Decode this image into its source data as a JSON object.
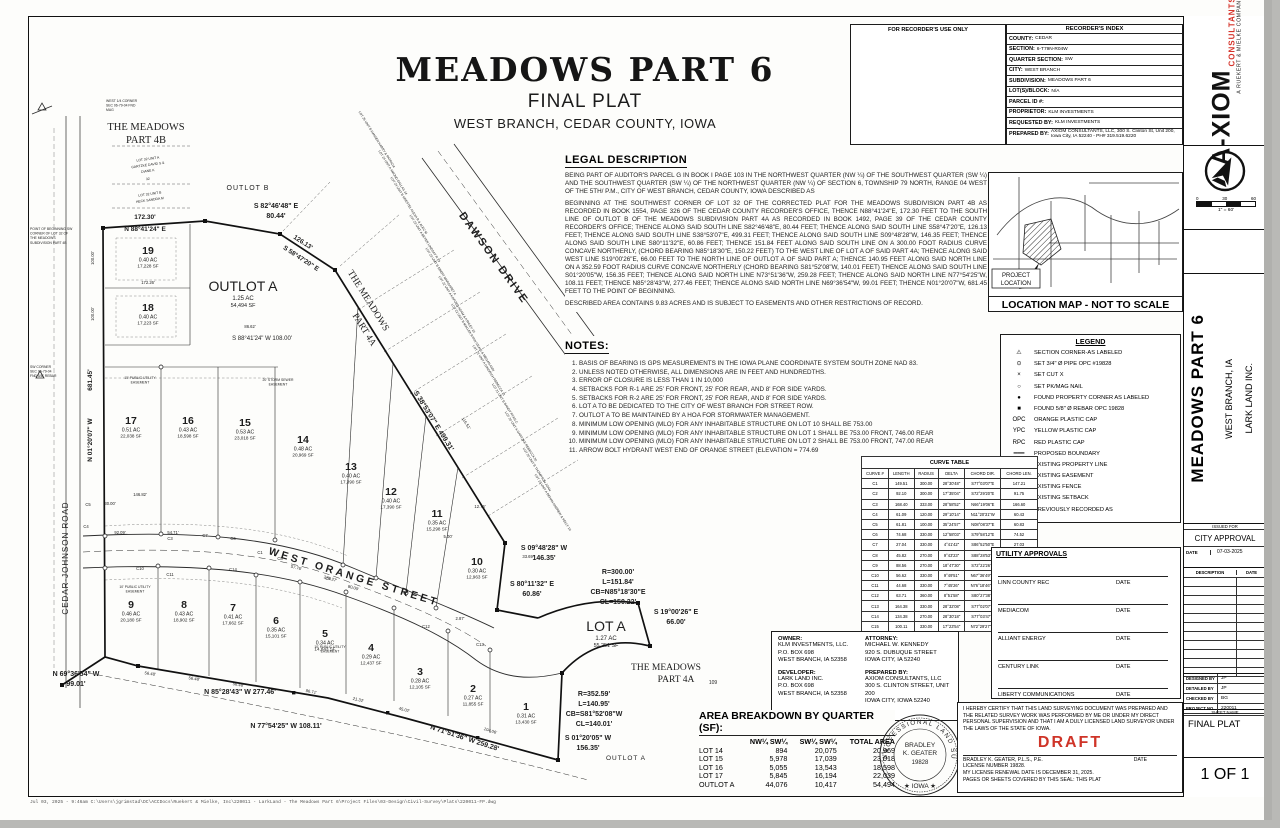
{
  "sheet": {
    "title": "MEADOWS PART 6",
    "subtitle": "FINAL PLAT",
    "location": "WEST BRANCH, CEDAR COUNTY, IOWA",
    "footer_path": "Jul 03, 2025 - 9:46am  C:\\Users\\jgrimstad\\DC\\ACCDocs\\Ruekert & Mielke, Inc\\220011 - LarkLand - The Meadows Part 6\\Project Files\\03-Design\\Civil-Survey\\Plats\\220011-FP.dwg"
  },
  "recorder": {
    "use_only": "FOR RECORDER'S USE ONLY",
    "index_title": "RECORDER'S INDEX",
    "rows": [
      {
        "label": "COUNTY:",
        "value": "CEDAR"
      },
      {
        "label": "SECTION:",
        "value": "6-T79N-R04W"
      },
      {
        "label": "QUARTER SECTION:",
        "value": "SW"
      },
      {
        "label": "CITY:",
        "value": "WEST BRANCH"
      },
      {
        "label": "SUBDIVISION:",
        "value": "MEADOWS PART 6"
      },
      {
        "label": "LOT(S)/BLOCK:",
        "value": "N/A"
      },
      {
        "label": "PARCEL ID #:",
        "value": ""
      },
      {
        "label": "PROPRIETOR:",
        "value": "KLM INVESTMENTS"
      },
      {
        "label": "REQUESTED BY:",
        "value": "KLM INVESTMENTS"
      },
      {
        "label": "PREPARED BY:",
        "value": "AXIOM CONSULTANTS, LLC, 300 S. Clinton St, Unit 200, Iowa City, IA 52240 - PH# 319.519.6220"
      }
    ]
  },
  "branding": {
    "logo_main": "A-XIOM",
    "logo_sub": "CONSULTANTS",
    "logo_tag": "A RUEKERT & MIELKE COMPANY",
    "scale_ticks": [
      "0",
      "30",
      "60"
    ],
    "scale_label": "1\" = 60'"
  },
  "legal_description": {
    "heading": "LEGAL DESCRIPTION",
    "p1": "BEING PART OF AUDITOR'S PARCEL G IN BOOK I PAGE 103 IN THE NORTHWEST QUARTER (NW ¼) OF THE SOUTHWEST QUARTER (SW ¼) AND THE SOUTHWEST QUARTER (SW ¼) OF THE NORTHWEST QUARTER (NW ¼) OF SECTION 6, TOWNSHIP 79 NORTH, RANGE 04 WEST OF THE 5TH/ P.M., CITY OF WEST BRANCH, CEDAR COUNTY, IOWA DESCRIBED AS",
    "p2": "BEGINNING AT THE SOUTHWEST CORNER OF LOT 32 OF THE CORRECTED PLAT FOR THE MEADOWS SUBDIVISION PART 4B AS RECORDED IN BOOK 1554, PAGE 326 OF THE CEDAR COUNTY RECORDER'S OFFICE, THENCE N88°41'24\"E, 172.30 FEET TO THE SOUTH LINE OF OUTLOT B OF THE MEADOWS SUBDIVISION PART 4A AS RECORDED IN BOOK 1492, PAGE 39 OF THE CEDAR COUNTY RECORDER'S OFFICE; THENCE ALONG SAID SOUTH LINE S82°46'48\"E, 80.44 FEET; THENCE ALONG SAID SOUTH LINE S58°47'20\"E, 126.13 FEET; THENCE ALONG SAID SOUTH LINE S38°53'07\"E, 499.31 FEET; THENCE ALONG SAID SOUTH LINE S09°48'28\"W, 146.35 FEET; THENCE ALONG SAID SOUTH LINE S80°11'32\"E, 60.86 FEET; THENCE 151.84 FEET ALONG SAID SOUTH LINE ON A 300.00 FOOT RADIUS CURVE CONCAVE NORTHERLY, (CHORD BEARING N85°18'30\"E, 150.22 FEET) TO THE WEST LINE OF LOT A OF SAID PART 4A; THENCE ALONG SAID WEST LINE S19°00'26\"E, 66.00 FEET TO THE NORTH LINE OF OUTLOT A OF SAID PART A; THENCE 140.95 FEET ALONG SAID NORTH LINE ON A 352.59 FOOT RADIUS CURVE CONCAVE NORTHERLY (CHORD BEARING S81°52'08\"W, 140.01 FEET) THENCE ALONG SAID SOUTH LINE S01°20'05\"W, 156.35 FEET; THENCE ALONG SAID NORTH LINE N73°51'36\"W, 259.28 FEET; THENCE ALONG SAID NORTH LINE N77°54'25\"W, 108.11 FEET; THENCE N85°28'43\"W, 277.46 FEET; THENCE ALONG SAID NORTH LINE N69°36'54\"W, 99.01 FEET; THENCE N01°20'07\"W, 681.45 FEET TO THE POINT OF BEGINNING.",
    "p3": "DESCRIBED AREA CONTAINS 9.83 ACRES AND IS SUBJECT TO EASEMENTS AND OTHER RESTRICTIONS OF RECORD."
  },
  "notes": {
    "heading": "NOTES:",
    "items": [
      "BASIS OF BEARING IS GPS MEASUREMENTS IN THE IOWA PLANE COORDINATE SYSTEM SOUTH ZONE NAD 83.",
      "UNLESS NOTED OTHERWISE, ALL DIMENSIONS ARE IN FEET AND HUNDREDTHS.",
      "ERROR OF CLOSURE IS LESS THAN 1 IN 10,000",
      "SETBACKS FOR R-1 ARE 25' FOR FRONT, 25' FOR REAR, AND 8' FOR SIDE YARDS.",
      "SETBACKS FOR R-2 ARE 25' FOR FRONT, 25' FOR REAR, AND 8' FOR SIDE YARDS.",
      "LOT A TO BE DEDICATED TO THE CITY OF WEST BRANCH FOR STREET ROW.",
      "OUTLOT A TO BE MAINTAINED BY A HOA FOR STORMWATER MANAGEMENT.",
      "MINIMUM LOW OPENING (MLO) FOR ANY INHABITABLE STRUCTURE ON LOT 10 SHALL BE 753.00",
      "MINIMUM LOW OPENING (MLO) FOR ANY INHABITABLE STRUCTURE ON LOT 1 SHALL BE 753.00 FRONT, 746.00 REAR",
      "MINIMUM LOW OPENING (MLO) FOR ANY INHABITABLE STRUCTURE ON LOT 2 SHALL BE 753.00 FRONT, 747.00 REAR",
      "ARROW BOLT HYDRANT WEST END OF ORANGE STREET (ELEVATION = 774.69"
    ]
  },
  "legend": {
    "title": "LEGEND",
    "items": [
      {
        "symbol": "⚠",
        "label": "SECTION CORNER-AS LABELED"
      },
      {
        "symbol": "⊙",
        "label": "SET 3/4\" Ø PIPE OPC #19828"
      },
      {
        "symbol": "×",
        "label": "SET CUT X"
      },
      {
        "symbol": "○",
        "label": "SET PK/MAG NAIL"
      },
      {
        "symbol": "●",
        "label": "FOUND PROPERTY CORNER AS LABELED"
      },
      {
        "symbol": "■",
        "label": "FOUND 5/8\" Ø REBAR OPC 19828"
      },
      {
        "symbol": "OPC",
        "label": "ORANGE PLASTIC CAP"
      },
      {
        "symbol": "YPC",
        "label": "YELLOW PLASTIC CAP"
      },
      {
        "symbol": "RPC",
        "label": "RED PLASTIC CAP"
      },
      {
        "symbol": "━━━",
        "label": "PROPOSED BOUNDARY"
      },
      {
        "symbol": "───",
        "label": "EXISTING PROPERTY LINE"
      },
      {
        "symbol": "— — —",
        "label": "EXISTING EASEMENT"
      },
      {
        "symbol": "—·—·—",
        "label": "EXISTING FENCE"
      },
      {
        "symbol": "·······",
        "label": "EXISTING SETBACK"
      },
      {
        "symbol": "(R)",
        "label": "PREVIOUSLY RECORDED AS"
      }
    ]
  },
  "curve_table": {
    "title": "CURVE TABLE",
    "headers": [
      "CURVE #",
      "LENGTH",
      "RADIUS",
      "DELTA",
      "CHORD DIR.",
      "CHORD LEN."
    ],
    "rows": [
      [
        "C1",
        "149.51",
        "300.00",
        "28°30'48\"",
        "S77°03'07\"E",
        "147.21"
      ],
      [
        "C2",
        "92.10",
        "300.00",
        "17°35'04\"",
        "S72°29'20\"E",
        "91.75"
      ],
      [
        "C3",
        "168.40",
        "333.00",
        "28°58'52\"",
        "N66°19'06\"E",
        "166.60"
      ],
      [
        "C4",
        "61.09",
        "120.00",
        "29°10'14\"",
        "N11°20'31\"W",
        "60.43"
      ],
      [
        "C5",
        "61.81",
        "100.00",
        "35°24'57\"",
        "N08°08'37\"E",
        "60.83"
      ],
      [
        "C6",
        "74.68",
        "330.00",
        "12°58'03\"",
        "S79°58'12\"E",
        "74.52"
      ],
      [
        "C7",
        "27.04",
        "330.00",
        "4°41'42\"",
        "S86°52'50\"E",
        "27.03"
      ],
      [
        "C8",
        "45.82",
        "270.00",
        "9°43'23\"",
        "S88°28'53\"E",
        "45.76"
      ],
      [
        "C9",
        "88.56",
        "270.00",
        "18°47'30\"",
        "S72°22'26\"E",
        "88.16"
      ],
      [
        "C10",
        "56.62",
        "330.00",
        "9°49'51\"",
        "N67°36'49\"W",
        "56.55"
      ],
      [
        "C11",
        "44.68",
        "330.00",
        "7°45'26\"",
        "N76°18'46\"W",
        "44.65"
      ],
      [
        "C12",
        "63.71",
        "360.00",
        "8°51'58\"",
        "S80°27'38\"E",
        "63.65"
      ],
      [
        "C13",
        "164.38",
        "330.00",
        "28°32'08\"",
        "S77°02'07\"E",
        "162.70"
      ],
      [
        "C14",
        "134.38",
        "270.00",
        "28°30'18\"",
        "S77°03'47\"E",
        "133.00"
      ],
      [
        "C15",
        "100.11",
        "330.00",
        "17°23'54\"",
        "N72°29'27\"W",
        "99.86"
      ]
    ]
  },
  "location_map": {
    "caption": "LOCATION MAP - NOT TO SCALE",
    "project_label_1": "PROJECT",
    "project_label_2": "LOCATION"
  },
  "utility_approvals": {
    "title": "UTILITY APPROVALS",
    "date_label": "DATE",
    "entries": [
      "LINN COUNTY REC",
      "MEDIACOM",
      "ALLIANT ENERGY",
      "CENTURY LINK",
      "LIBERTY COMMUNICATIONS"
    ]
  },
  "parties": {
    "owner_heading": "OWNER:",
    "owner_lines": [
      "KLM INVESTMENTS, LLC.",
      "P.O. BOX 698",
      "WEST BRANCH, IA 52358"
    ],
    "developer_heading": "DEVELOPER:",
    "developer_lines": [
      "LARK LAND INC.",
      "P.O.  BOX 698",
      "WEST BRANCH, IA 52358"
    ],
    "attorney_heading": "ATTORNEY:",
    "attorney_lines": [
      "MICHAEL W. KENNEDY",
      "920 S. DUBUQUE STREET",
      "IOWA CITY, IA 52240"
    ],
    "prepared_heading": "PREPARED BY:",
    "prepared_lines": [
      "AXIOM CONSULTANTS, LLC",
      "300 S. CLINTON STREET, UNIT 200",
      "IOWA CITY, IOWA 52240"
    ]
  },
  "area_breakdown": {
    "title": "AREA BREAKDOWN BY QUARTER (SF):",
    "headers": [
      "",
      "NW¼ SW¼",
      "SW¼ SW¼",
      "TOTAL AREA"
    ],
    "rows": [
      [
        "LOT 14",
        "894",
        "20,075",
        "20,969"
      ],
      [
        "LOT 15",
        "5,978",
        "17,039",
        "23,018"
      ],
      [
        "LOT 16",
        "5,055",
        "13,543",
        "18,598"
      ],
      [
        "LOT 17",
        "5,845",
        "16,194",
        "22,039"
      ],
      [
        "OUTLOT A",
        "44,076",
        "10,417",
        "54,494"
      ]
    ]
  },
  "certification": {
    "text": "I HEREBY CERTIFY THAT THIS LAND SURVEYING DOCUMENT WAS PREPARED AND THE RELATED SURVEY WORK WAS PERFORMED BY ME OR UNDER MY DIRECT PERSONAL SUPERVISION AND THAT I AM A DULY LICENSED  LAND SURVEYOR UNDER THE LAWS OF THE STATE OF IOWA.",
    "draft_label": "DRAFT",
    "surveyor_line": "BRADLEY K. GEATER, P.L.S., P.E.",
    "date_label": "DATE",
    "license_line": "LICENSE NUMBER 19828.",
    "renewal_line": "MY LICENSE RENEWAL DATE IS DECEMBER 31, 2025.",
    "coverage_line": "PAGES OR SHEETS COVERED BY THIS SEAL: THIS PLAT",
    "seal": {
      "arc_text": "PROFESSIONAL LAND SURVEYOR",
      "name1": "BRADLEY",
      "name2": "K. GEATER",
      "number": "19828",
      "state": "★ IOWA ★"
    }
  },
  "title_block": {
    "project": "MEADOWS PART 6",
    "city": "WEST BRANCH, IA",
    "client": "LARK LAND INC.",
    "issued_for_label": "ISSUED FOR",
    "issued_for": "CITY APPROVAL",
    "date_label": "DATE",
    "date": "07-03-2025",
    "description_label": "DESCRIPTION",
    "rev_date_label": "DATE",
    "designed_by_label": "DESIGNED BY",
    "designed_by": "JP",
    "detailed_by_label": "DETAILED BY",
    "detailed_by": "JP",
    "checked_by_label": "CHECKED BY",
    "checked_by": "BG",
    "project_no_label": "PROJECT NO.",
    "project_no": "220011",
    "sheet_name_label": "SHEET NAME",
    "sheet_name": "FINAL PLAT",
    "sheet_no": "1 OF 1"
  },
  "plat": {
    "labels": {
      "cedar_johnson": "CEDAR-JOHNSON ROAD",
      "west_orange": "WEST ORANGE STREET",
      "dawson": "DAWSON DRIVE",
      "meadows_4b_1": "THE MEADOWS",
      "meadows_4b_2": "PART 4B",
      "meadows_4a_diag_1": "THE MEADOWS",
      "meadows_4a_diag_2": "PART 4A",
      "meadows_4a_h_1": "THE MEADOWS",
      "meadows_4a_h_2": "PART 4A",
      "lot109": "109",
      "outlot_b": "OUTLOT B",
      "outlot_a_small": "OUTLOT A"
    },
    "lots": [
      {
        "id": "1",
        "ac": "0.31 AC",
        "sf": "13,430 SF"
      },
      {
        "id": "2",
        "ac": "0.27 AC",
        "sf": "11,855 SF"
      },
      {
        "id": "3",
        "ac": "0.28 AC",
        "sf": "12,105 SF"
      },
      {
        "id": "4",
        "ac": "0.29 AC",
        "sf": "12,437 SF"
      },
      {
        "id": "5",
        "ac": "0.34 AC",
        "sf": "14,843 SF"
      },
      {
        "id": "6",
        "ac": "0.35 AC",
        "sf": "15,101 SF"
      },
      {
        "id": "7",
        "ac": "0.41 AC",
        "sf": "17,662 SF"
      },
      {
        "id": "8",
        "ac": "0.43 AC",
        "sf": "18,902 SF"
      },
      {
        "id": "9",
        "ac": "0.46 AC",
        "sf": "20,180 SF"
      },
      {
        "id": "10",
        "ac": "0.30 AC",
        "sf": "12,963 SF"
      },
      {
        "id": "11",
        "ac": "0.35 AC",
        "sf": "15,298 SF"
      },
      {
        "id": "12",
        "ac": "0.40 AC",
        "sf": "17,390 SF"
      },
      {
        "id": "13",
        "ac": "0.40 AC",
        "sf": "17,390 SF"
      },
      {
        "id": "14",
        "ac": "0.48 AC",
        "sf": "20,969 SF"
      },
      {
        "id": "15",
        "ac": "0.53 AC",
        "sf": "23,018 SF"
      },
      {
        "id": "16",
        "ac": "0.43 AC",
        "sf": "18,598 SF"
      },
      {
        "id": "17",
        "ac": "0.51 AC",
        "sf": "22,038 SF"
      },
      {
        "id": "18",
        "ac": "0.40 AC",
        "sf": "17,223 SF"
      },
      {
        "id": "19",
        "ac": "0.40 AC",
        "sf": "17,228 SF"
      },
      {
        "id": "OUTLOT A",
        "ac": "1.25 AC",
        "sf": "54,494 SF",
        "big": true
      },
      {
        "id": "LOT A",
        "ac": "1.27 AC",
        "sf": "55,251 SF",
        "big": true
      }
    ],
    "bearings": [
      {
        "lines": [
          "172.30'"
        ]
      },
      {
        "lines": [
          "N 88°41'24\" E"
        ]
      },
      {
        "lines": [
          "S 82°46'48\" E",
          "80.44'"
        ]
      },
      {
        "lines": [
          "126.13'"
        ]
      },
      {
        "lines": [
          "S 58°47'20\" E"
        ]
      },
      {
        "lines": [
          "S 38°53'07\" E   499.31'"
        ]
      },
      {
        "lines": [
          "S 09°48'28\" W",
          "146.35'"
        ]
      },
      {
        "lines": [
          "S 80°11'32\" E",
          "60.86'"
        ]
      },
      {
        "lines": [
          "R=300.00'",
          "L=151.84'",
          "CB=N85°18'30\"E",
          "CL=150.22'"
        ]
      },
      {
        "lines": [
          "S 19°00'26\" E",
          "66.00'"
        ]
      },
      {
        "lines": [
          "R=352.59'",
          "L=140.95'",
          "CB=S81°52'08\"W",
          "CL=140.01'"
        ]
      },
      {
        "lines": [
          "S 01°20'05\" W",
          "156.35'"
        ]
      },
      {
        "lines": [
          "N 71°51'36\" W    259.28'"
        ]
      },
      {
        "lines": [
          "N 77°54'25\" W     108.11'"
        ]
      },
      {
        "lines": [
          "N 85°28'43\" W    277.46'"
        ]
      },
      {
        "lines": [
          "N 69°36'54\" W",
          "99.01'"
        ]
      },
      {
        "lines": [
          "N 01°20'07\" W"
        ]
      },
      {
        "lines": [
          "681.45'"
        ]
      },
      {
        "lines": [
          "S 88°41'24\" W      108.00'"
        ]
      }
    ],
    "dims": [
      "100.00'",
      "100.00'",
      "172.26'",
      "86.62'",
      "146.82'",
      "30.00'",
      "92.09'",
      "54.71'",
      "56.48'",
      "56.48'",
      "56.48'",
      "86.71'",
      "21.32'",
      "45.02'",
      "57.76'",
      "276.27'",
      "80.00'",
      "116.51'",
      "12.76'",
      "5.00'",
      "2.87'",
      "104.06'",
      "33.69'"
    ],
    "curve_refs": [
      "C1",
      "C3",
      "C4",
      "C5",
      "C6",
      "C7",
      "C8",
      "C9",
      "C10",
      "C11",
      "C12",
      "C13",
      "C14"
    ],
    "easements": [
      "15' PUBLIC UTILITY EASEMENT",
      "20' STORM SEWER EASEMENT",
      "10' PUBLIC UTILITY EASEMENT",
      "10' PUBLIC UTILITY EASEMENT"
    ],
    "lot32_labels": [
      "LOT 32 UNIT A",
      "GARTZKE DAVID S &",
      "DIANE K",
      "32",
      "LOT 32 UNIT B",
      "HECK SANDRA M"
    ],
    "neighbor_owners": [
      "LOT 25 UNIT B  HANSEN HARRY & PATRICIA",
      "LOT 24 UNIT A  AMOND DALLAS  24",
      "LOT 24 UNIT B  KRESTEL ALEXA R & ALEC M",
      "LOT 23 UNIT A  BEYER LINDSAY R  23",
      "LOT 23 UNIT B  EBERT MARGARET A",
      "LOT 22 UNIT A  KOFOED ADAM & ASHLEY  22",
      "LOT 22 UNIT B  MALLEK RYAN CRAIG & MEGAN ANN",
      "LOT 21 UNIT A  GINGRICH REBECCA  21",
      "LOT 21 UNIT B  BANDY RYAN C",
      "LOT 20 UNIT A  GARTZKE REBECCA  20",
      "LOT 20 UNIT B  THOMPSON JOAN",
      "LOT 19 UNIT A  BEHAN ANDREW & KELLY  19"
    ],
    "corner_notes": [
      {
        "lines": [
          "WEST 1/4 CORNER",
          "SEC 06-79-04 FND",
          "MAG"
        ]
      },
      {
        "lines": [
          "POINT OF BEGINNING SW",
          "CORNER OF LOT 32 OF",
          "THE MEADOWS",
          "SUBDIVISION PART 4B"
        ]
      },
      {
        "lines": [
          "SW CORNER",
          "SEC 06-79-04",
          "FND 5/8\" REBAR"
        ]
      }
    ]
  }
}
